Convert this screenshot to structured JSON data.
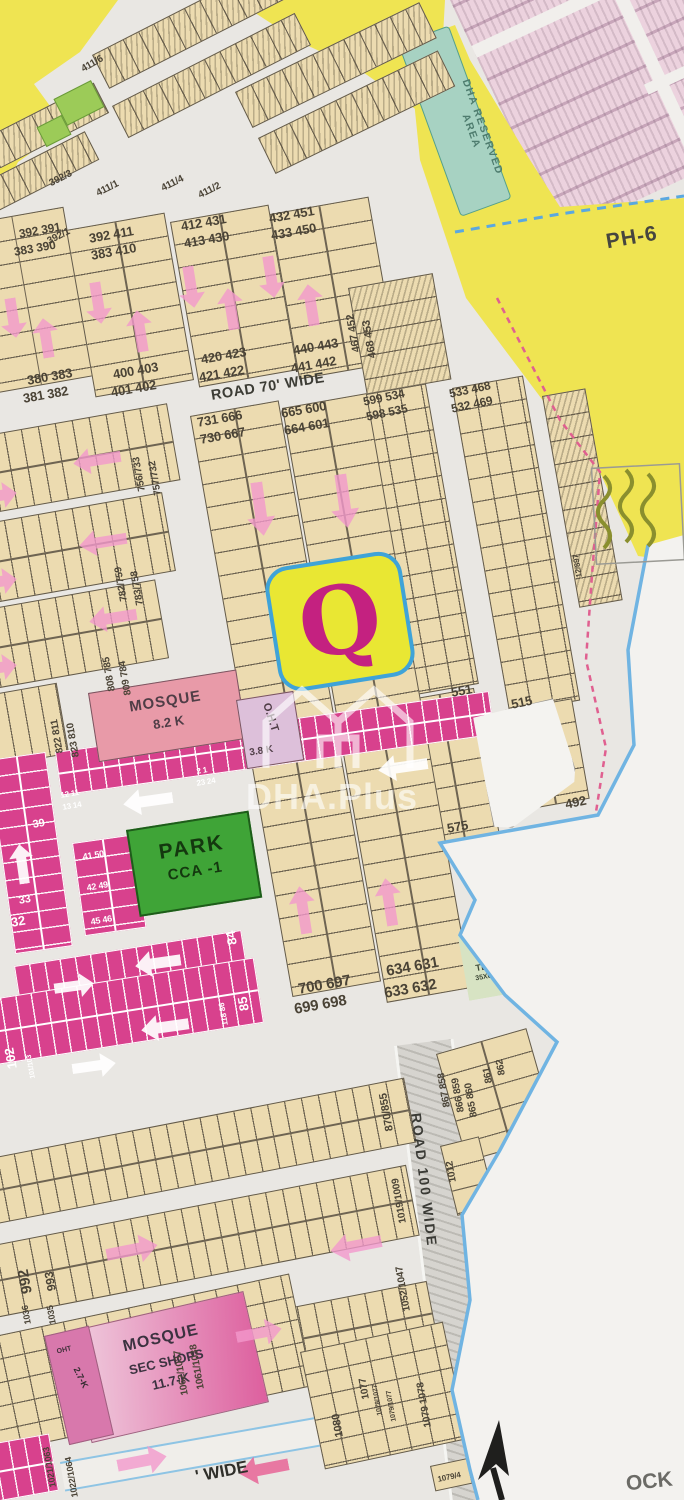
{
  "map": {
    "block_letter": "Q",
    "phase_label": "PH-6",
    "reserved": {
      "line1": "DHA RESERVED",
      "line2": "AREA"
    },
    "roads": {
      "road70": "ROAD 70' WIDE",
      "road100": "ROAD 100 WIDE",
      "bottom_fragment": "' WIDE"
    },
    "corner_fragment": "OCK",
    "watermark": {
      "brand": "DHA.Plus"
    },
    "park": {
      "line1": "PARK",
      "line2": "CCA -1"
    },
    "mosque_main": {
      "name": "MOSQUE",
      "area": "8.2 K"
    },
    "oht_main": {
      "name": "O.H.T",
      "area": "3.8 K"
    },
    "mosque_sector": {
      "name": "MOSQUE",
      "line2": "SEC SHOPS",
      "area": "11.7-K"
    },
    "oht_sector": {
      "name": "OHT",
      "area": "2.7-K"
    },
    "tbs": {
      "name": "TBS",
      "size": "35X65"
    }
  },
  "colors": {
    "ink": "#4a4336",
    "white": "#ffffff",
    "gray": "#6b6b66",
    "road_ink": "#3a3a35",
    "teal_ink": "#4e7c6e",
    "tbs_ink": "#3f4a38",
    "arrow_pink": "rgba(242,153,204,0.8)",
    "arrow_white": "rgba(255,255,255,0.92)",
    "arrow_red": "rgba(232,100,150,0.85)",
    "accent_yellow": "#efe452",
    "accent_magenta": "#d8418d",
    "park_green": "#3fa437",
    "q_pink": "#c42180",
    "boundary_blue": "#70b4e2"
  },
  "plot_labels": [
    {
      "t": "411/6",
      "x": 80,
      "y": 66,
      "r": -30,
      "s": 10
    },
    {
      "t": "392/3",
      "x": 48,
      "y": 180,
      "r": -27,
      "s": 10
    },
    {
      "t": "411/1",
      "x": 95,
      "y": 190,
      "r": -27,
      "s": 10
    },
    {
      "t": "411/4",
      "x": 160,
      "y": 185,
      "r": -27,
      "s": 10
    },
    {
      "t": "411/2",
      "x": 197,
      "y": 192,
      "r": -27,
      "s": 10
    },
    {
      "t": "392/1",
      "x": 46,
      "y": 238,
      "r": -27,
      "s": 10
    },
    {
      "t": "392 391",
      "x": 18,
      "y": 228,
      "r": -10,
      "s": 12
    },
    {
      "t": "383 390",
      "x": 13,
      "y": 246,
      "r": -10,
      "s": 12
    },
    {
      "t": "380 383",
      "x": 26,
      "y": 374,
      "r": -10,
      "s": 13
    },
    {
      "t": "381 382",
      "x": 22,
      "y": 392,
      "r": -10,
      "s": 13
    },
    {
      "t": "392 411",
      "x": 88,
      "y": 232,
      "r": -10,
      "s": 13
    },
    {
      "t": "383 410",
      "x": 90,
      "y": 249,
      "r": -10,
      "s": 13
    },
    {
      "t": "400 403",
      "x": 112,
      "y": 368,
      "r": -10,
      "s": 13
    },
    {
      "t": "401 402",
      "x": 110,
      "y": 386,
      "r": -10,
      "s": 13
    },
    {
      "t": "412 431",
      "x": 180,
      "y": 220,
      "r": -10,
      "s": 13
    },
    {
      "t": "413 430",
      "x": 183,
      "y": 237,
      "r": -10,
      "s": 13
    },
    {
      "t": "420 423",
      "x": 200,
      "y": 353,
      "r": -10,
      "s": 13
    },
    {
      "t": "421 422",
      "x": 198,
      "y": 371,
      "r": -10,
      "s": 13
    },
    {
      "t": "432 451",
      "x": 268,
      "y": 212,
      "r": -10,
      "s": 13
    },
    {
      "t": "433 450",
      "x": 270,
      "y": 229,
      "r": -10,
      "s": 13
    },
    {
      "t": "440 443",
      "x": 292,
      "y": 344,
      "r": -10,
      "s": 13
    },
    {
      "t": "441 442",
      "x": 290,
      "y": 362,
      "r": -10,
      "s": 13
    },
    {
      "t": "467 452",
      "x": 352,
      "y": 353,
      "r": -100,
      "s": 11
    },
    {
      "t": "468 453",
      "x": 368,
      "y": 359,
      "r": -100,
      "s": 11
    },
    {
      "t": "599 534",
      "x": 362,
      "y": 396,
      "r": -12,
      "s": 12
    },
    {
      "t": "598 535",
      "x": 365,
      "y": 411,
      "r": -12,
      "s": 12
    },
    {
      "t": "533 468",
      "x": 448,
      "y": 388,
      "r": -12,
      "s": 12
    },
    {
      "t": "532 469",
      "x": 450,
      "y": 403,
      "r": -12,
      "s": 12
    },
    {
      "t": "731 666",
      "x": 196,
      "y": 416,
      "r": -10,
      "s": 13
    },
    {
      "t": "730 667",
      "x": 199,
      "y": 433,
      "r": -10,
      "s": 13
    },
    {
      "t": "665 600",
      "x": 280,
      "y": 407,
      "r": -10,
      "s": 13
    },
    {
      "t": "664 601",
      "x": 283,
      "y": 424,
      "r": -10,
      "s": 13
    },
    {
      "t": "756/733",
      "x": 138,
      "y": 492,
      "r": -100,
      "s": 10
    },
    {
      "t": "757/732",
      "x": 154,
      "y": 496,
      "r": -100,
      "s": 10
    },
    {
      "t": "782/759",
      "x": 120,
      "y": 602,
      "r": -100,
      "s": 10
    },
    {
      "t": "783/758",
      "x": 136,
      "y": 606,
      "r": -100,
      "s": 10
    },
    {
      "t": "808 785",
      "x": 108,
      "y": 692,
      "r": -100,
      "s": 10
    },
    {
      "t": "809 784",
      "x": 124,
      "y": 696,
      "r": -100,
      "s": 10
    },
    {
      "t": "822 811",
      "x": 56,
      "y": 754,
      "r": -100,
      "s": 10
    },
    {
      "t": "823 810",
      "x": 72,
      "y": 758,
      "r": -100,
      "s": 10
    },
    {
      "t": "551",
      "x": 450,
      "y": 686,
      "r": -10,
      "s": 13
    },
    {
      "t": "515",
      "x": 510,
      "y": 698,
      "r": -12,
      "s": 13
    },
    {
      "t": "575",
      "x": 446,
      "y": 822,
      "r": -10,
      "s": 13
    },
    {
      "t": "492",
      "x": 564,
      "y": 798,
      "r": -12,
      "s": 13
    },
    {
      "t": "12/897",
      "x": 576,
      "y": 578,
      "r": -100,
      "s": 8
    },
    {
      "t": "700 697",
      "x": 297,
      "y": 982,
      "r": -10,
      "s": 15
    },
    {
      "t": "699 698",
      "x": 293,
      "y": 1002,
      "r": -10,
      "s": 15
    },
    {
      "t": "634 631",
      "x": 385,
      "y": 964,
      "r": -10,
      "s": 15
    },
    {
      "t": "633 632",
      "x": 383,
      "y": 986,
      "r": -10,
      "s": 15
    },
    {
      "t": "84",
      "x": 226,
      "y": 946,
      "r": -100,
      "s": 13,
      "c": "white"
    },
    {
      "t": "85",
      "x": 238,
      "y": 1012,
      "r": -100,
      "s": 13,
      "c": "white"
    },
    {
      "t": "118 86",
      "x": 222,
      "y": 1026,
      "r": -100,
      "s": 8,
      "c": "white"
    },
    {
      "t": "102",
      "x": 6,
      "y": 1070,
      "r": -100,
      "s": 13,
      "c": "white"
    },
    {
      "t": "101/103",
      "x": 30,
      "y": 1079,
      "r": -100,
      "s": 7,
      "c": "white"
    },
    {
      "t": "39",
      "x": 32,
      "y": 820,
      "r": -10,
      "s": 11,
      "c": "white"
    },
    {
      "t": "33",
      "x": 18,
      "y": 896,
      "r": -10,
      "s": 11,
      "c": "white"
    },
    {
      "t": "32",
      "x": 10,
      "y": 916,
      "r": -10,
      "s": 13,
      "c": "white"
    },
    {
      "t": "41 50",
      "x": 82,
      "y": 853,
      "r": -10,
      "s": 9,
      "c": "white"
    },
    {
      "t": "42 49",
      "x": 86,
      "y": 884,
      "r": -10,
      "s": 9,
      "c": "white"
    },
    {
      "t": "45 46",
      "x": 90,
      "y": 918,
      "r": -10,
      "s": 9,
      "c": "white"
    },
    {
      "t": "12 11",
      "x": 60,
      "y": 792,
      "r": -10,
      "s": 8,
      "c": "white"
    },
    {
      "t": "13 14",
      "x": 62,
      "y": 804,
      "r": -10,
      "s": 8,
      "c": "white"
    },
    {
      "t": "2 1",
      "x": 196,
      "y": 768,
      "r": -10,
      "s": 8,
      "c": "white"
    },
    {
      "t": "23 24",
      "x": 196,
      "y": 780,
      "r": -10,
      "s": 8,
      "c": "white"
    },
    {
      "t": "870/855",
      "x": 385,
      "y": 1132,
      "r": -100,
      "s": 11
    },
    {
      "t": "1019/1009",
      "x": 399,
      "y": 1224,
      "r": -100,
      "s": 10
    },
    {
      "t": "867 858",
      "x": 443,
      "y": 1108,
      "r": -100,
      "s": 10
    },
    {
      "t": "866 859",
      "x": 457,
      "y": 1113,
      "r": -100,
      "s": 10
    },
    {
      "t": "865 860",
      "x": 470,
      "y": 1118,
      "r": -100,
      "s": 10
    },
    {
      "t": "861",
      "x": 485,
      "y": 1084,
      "r": -100,
      "s": 10
    },
    {
      "t": "862",
      "x": 498,
      "y": 1076,
      "r": -100,
      "s": 10
    },
    {
      "t": "1012",
      "x": 449,
      "y": 1183,
      "r": -100,
      "s": 10
    },
    {
      "t": "1052/1047",
      "x": 403,
      "y": 1312,
      "r": -100,
      "s": 10
    },
    {
      "t": "992",
      "x": 20,
      "y": 1295,
      "r": -100,
      "s": 15
    },
    {
      "t": "1036",
      "x": 24,
      "y": 1325,
      "r": -100,
      "s": 9
    },
    {
      "t": "993",
      "x": 46,
      "y": 1292,
      "r": -100,
      "s": 12
    },
    {
      "t": "1035",
      "x": 49,
      "y": 1325,
      "r": -100,
      "s": 9
    },
    {
      "t": "1062/1037",
      "x": 181,
      "y": 1396,
      "r": -100,
      "s": 10
    },
    {
      "t": "1061/1038",
      "x": 197,
      "y": 1390,
      "r": -100,
      "s": 10
    },
    {
      "t": "1021/1063",
      "x": 49,
      "y": 1488,
      "r": -100,
      "s": 9
    },
    {
      "t": "1022/1064",
      "x": 71,
      "y": 1498,
      "r": -100,
      "s": 9
    },
    {
      "t": "1080",
      "x": 335,
      "y": 1438,
      "r": -100,
      "s": 11
    },
    {
      "t": "1077",
      "x": 362,
      "y": 1400,
      "r": -100,
      "s": 10
    },
    {
      "t": "1078/1077",
      "x": 377,
      "y": 1416,
      "r": -100,
      "s": 7
    },
    {
      "t": "1079/1077",
      "x": 391,
      "y": 1422,
      "r": -100,
      "s": 7
    },
    {
      "t": "1079 1078",
      "x": 424,
      "y": 1428,
      "r": -100,
      "s": 10
    },
    {
      "t": "1079/4",
      "x": 437,
      "y": 1476,
      "r": -12,
      "s": 8
    }
  ],
  "arrows": [
    {
      "x": 0,
      "y": 298,
      "w": 26,
      "h": 40,
      "r": 171,
      "c": "arrow_pink"
    },
    {
      "x": 33,
      "y": 318,
      "w": 26,
      "h": 40,
      "r": -9,
      "c": "arrow_pink"
    },
    {
      "x": 85,
      "y": 282,
      "w": 26,
      "h": 42,
      "r": 171,
      "c": "arrow_pink"
    },
    {
      "x": 127,
      "y": 310,
      "w": 26,
      "h": 42,
      "r": -9,
      "c": "arrow_pink"
    },
    {
      "x": 178,
      "y": 266,
      "w": 26,
      "h": 42,
      "r": 171,
      "c": "arrow_pink"
    },
    {
      "x": 218,
      "y": 288,
      "w": 26,
      "h": 42,
      "r": -9,
      "c": "arrow_pink"
    },
    {
      "x": 258,
      "y": 256,
      "w": 26,
      "h": 42,
      "r": 171,
      "c": "arrow_pink"
    },
    {
      "x": 298,
      "y": 284,
      "w": 26,
      "h": 42,
      "r": -9,
      "c": "arrow_pink"
    },
    {
      "x": 246,
      "y": 482,
      "w": 28,
      "h": 54,
      "r": 172,
      "c": "arrow_pink"
    },
    {
      "x": 330,
      "y": 474,
      "w": 28,
      "h": 54,
      "r": 172,
      "c": "arrow_pink"
    },
    {
      "x": 290,
      "y": 886,
      "w": 26,
      "h": 48,
      "r": -9,
      "c": "arrow_pink"
    },
    {
      "x": 376,
      "y": 878,
      "w": 26,
      "h": 48,
      "r": -9,
      "c": "arrow_pink"
    },
    {
      "x": 84,
      "y": 436,
      "w": 26,
      "h": 48,
      "r": -99,
      "c": "arrow_pink"
    },
    {
      "x": 90,
      "y": 518,
      "w": 26,
      "h": 48,
      "r": -99,
      "c": "arrow_pink"
    },
    {
      "x": 100,
      "y": 594,
      "w": 26,
      "h": 48,
      "r": -99,
      "c": "arrow_pink"
    },
    {
      "x": -16,
      "y": 476,
      "w": 26,
      "h": 40,
      "r": 81,
      "c": "arrow_pink"
    },
    {
      "x": -16,
      "y": 562,
      "w": 26,
      "h": 40,
      "r": 81,
      "c": "arrow_pink"
    },
    {
      "x": -16,
      "y": 648,
      "w": 26,
      "h": 40,
      "r": 81,
      "c": "arrow_pink"
    },
    {
      "x": 135,
      "y": 776,
      "w": 26,
      "h": 50,
      "r": -98,
      "c": "arrow_white"
    },
    {
      "x": 390,
      "y": 742,
      "w": 26,
      "h": 50,
      "r": -98,
      "c": "arrow_white"
    },
    {
      "x": 145,
      "y": 940,
      "w": 26,
      "h": 46,
      "r": -98,
      "c": "arrow_white"
    },
    {
      "x": 62,
      "y": 966,
      "w": 24,
      "h": 40,
      "r": 82,
      "c": "arrow_white"
    },
    {
      "x": 152,
      "y": 1003,
      "w": 26,
      "h": 48,
      "r": -98,
      "c": "arrow_white"
    },
    {
      "x": 82,
      "y": 1044,
      "w": 24,
      "h": 44,
      "r": 82,
      "c": "arrow_white"
    },
    {
      "x": 10,
      "y": 844,
      "w": 24,
      "h": 40,
      "r": -8,
      "c": "arrow_white"
    },
    {
      "x": 118,
      "y": 1224,
      "w": 28,
      "h": 52,
      "r": 79,
      "c": "arrow_pink"
    },
    {
      "x": 342,
      "y": 1220,
      "w": 28,
      "h": 52,
      "r": -101,
      "c": "arrow_pink"
    },
    {
      "x": 246,
      "y": 1310,
      "w": 26,
      "h": 46,
      "r": 79,
      "c": "arrow_pink"
    },
    {
      "x": 128,
      "y": 1436,
      "w": 28,
      "h": 50,
      "r": 79,
      "c": "arrow_pink"
    },
    {
      "x": 250,
      "y": 1444,
      "w": 28,
      "h": 50,
      "r": -101,
      "c": "arrow_red"
    }
  ]
}
